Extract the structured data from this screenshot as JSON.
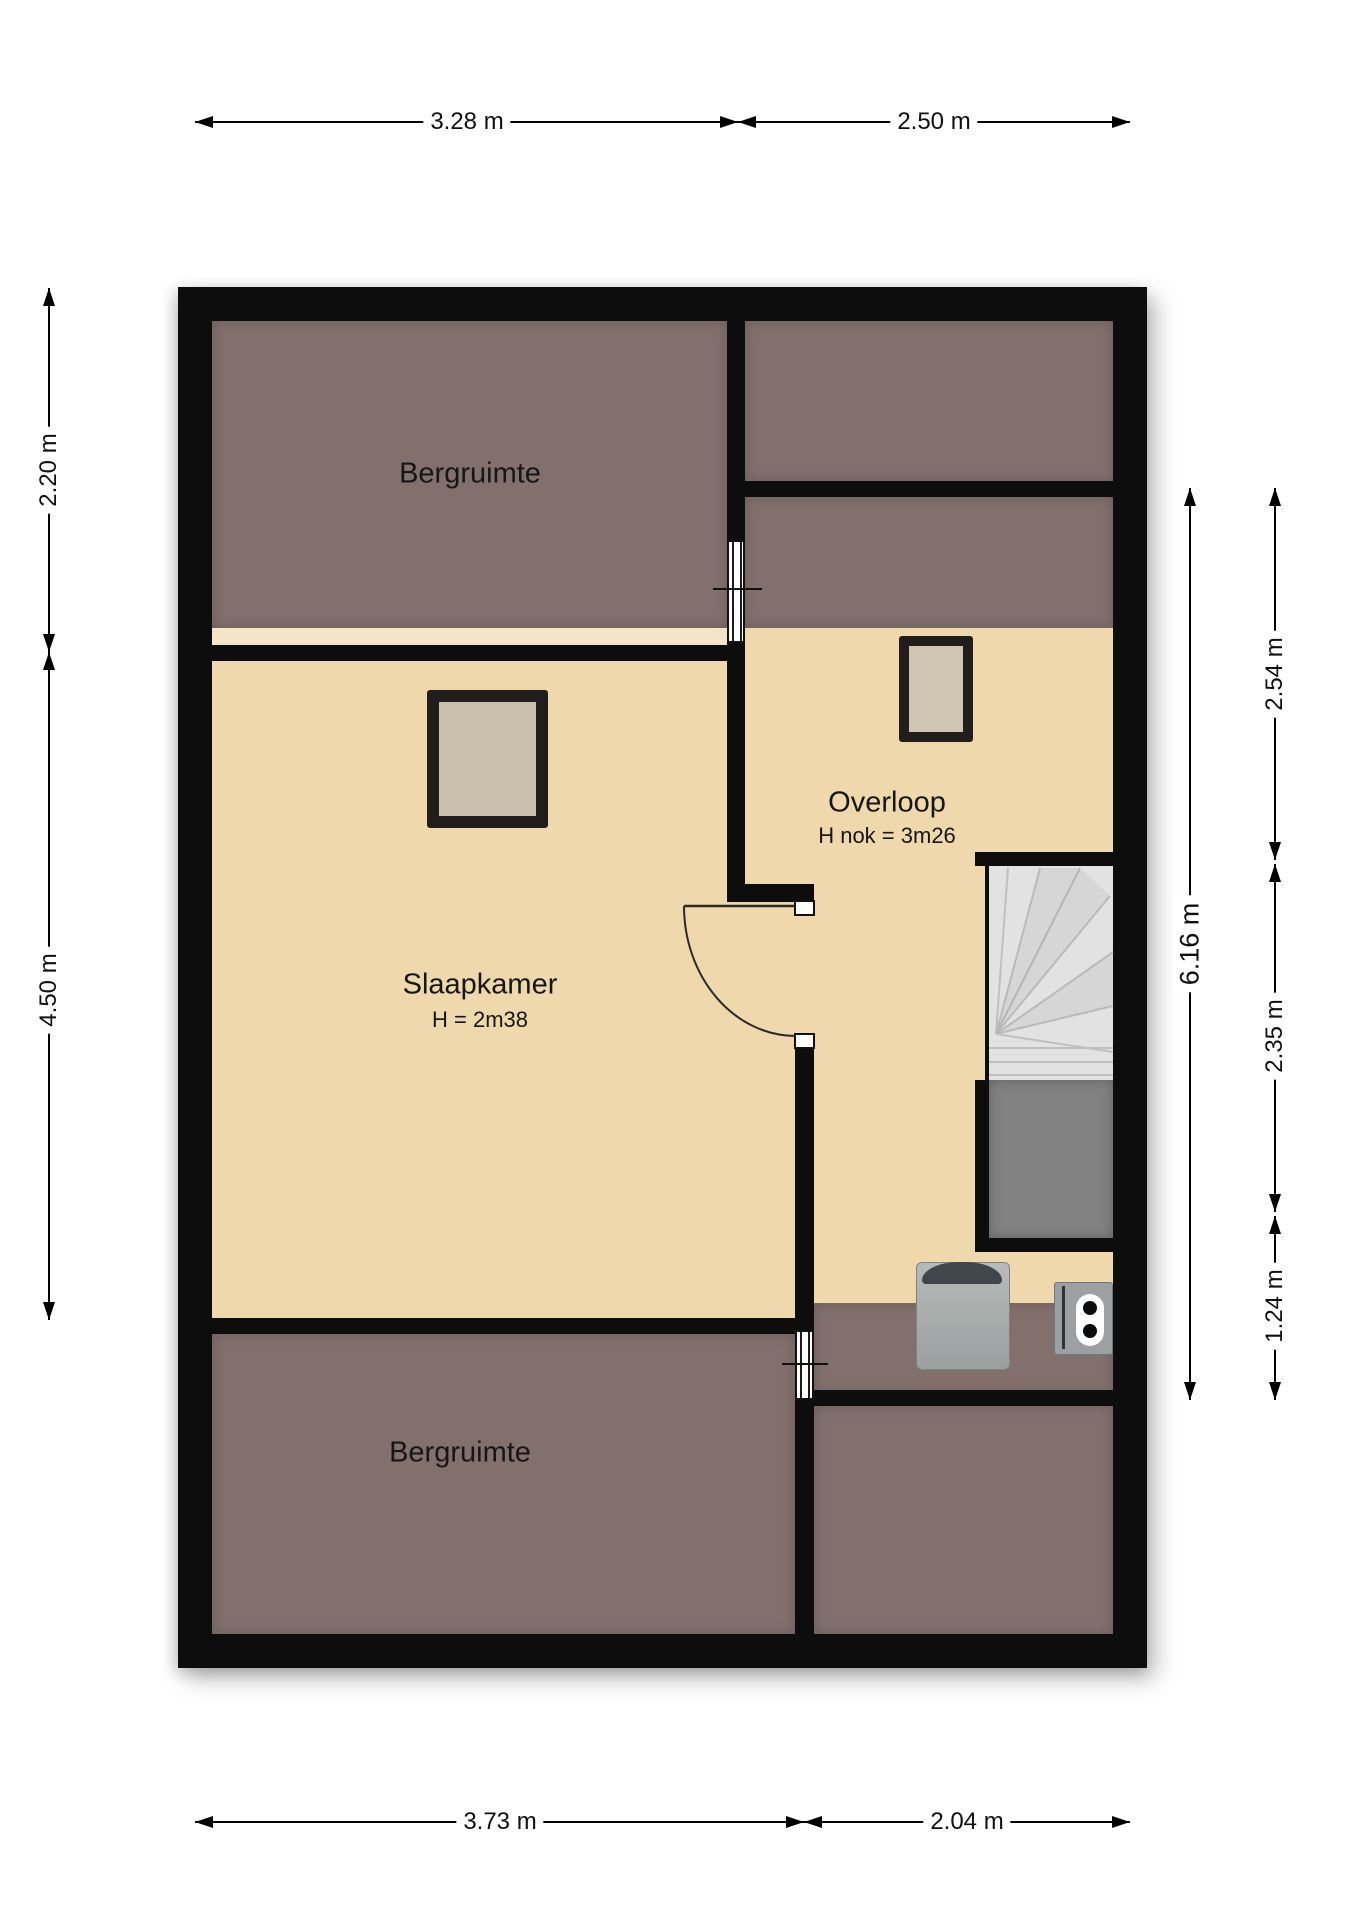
{
  "title": "Floor plan - attic storey",
  "rooms": {
    "bergruimte_top": {
      "label": "Bergruimte"
    },
    "overloop": {
      "label": "Overloop",
      "height_note": "H nok = 3m26"
    },
    "slaapkamer": {
      "label": "Slaapkamer",
      "height_note": "H = 2m38"
    },
    "bergruimte_bottom": {
      "label": "Bergruimte"
    }
  },
  "dimensions": {
    "top": [
      {
        "label": "3.28 m"
      },
      {
        "label": "2.50 m"
      }
    ],
    "bottom": [
      {
        "label": "3.73 m"
      },
      {
        "label": "2.04 m"
      }
    ],
    "left": [
      {
        "label": "2.20 m"
      },
      {
        "label": "4.50 m"
      }
    ],
    "right": [
      {
        "label": "2.54 m"
      },
      {
        "label": "2.35 m"
      },
      {
        "label": "1.24 m"
      }
    ],
    "right_total": {
      "label": "6.16 m"
    }
  },
  "icons": {
    "window_symbol": "striped window in wall",
    "skylight_symbol": "roof window / skylight",
    "door_symbol": "door with 90-degree swing arc",
    "staircase_symbol": "winder staircase with landing",
    "washing_machine_icon": "washing machine seen from top",
    "boiler_icon": "boiler unit with two knobs"
  },
  "colors": {
    "wall": "#0d0d0d",
    "floor_light": "#efd8ab",
    "floor_dark": "#82706d",
    "knee_strip": "#f5e5c6",
    "stairs_light": "#e2e2e2",
    "stairs_dark": "#828282",
    "background": "#ffffff"
  }
}
